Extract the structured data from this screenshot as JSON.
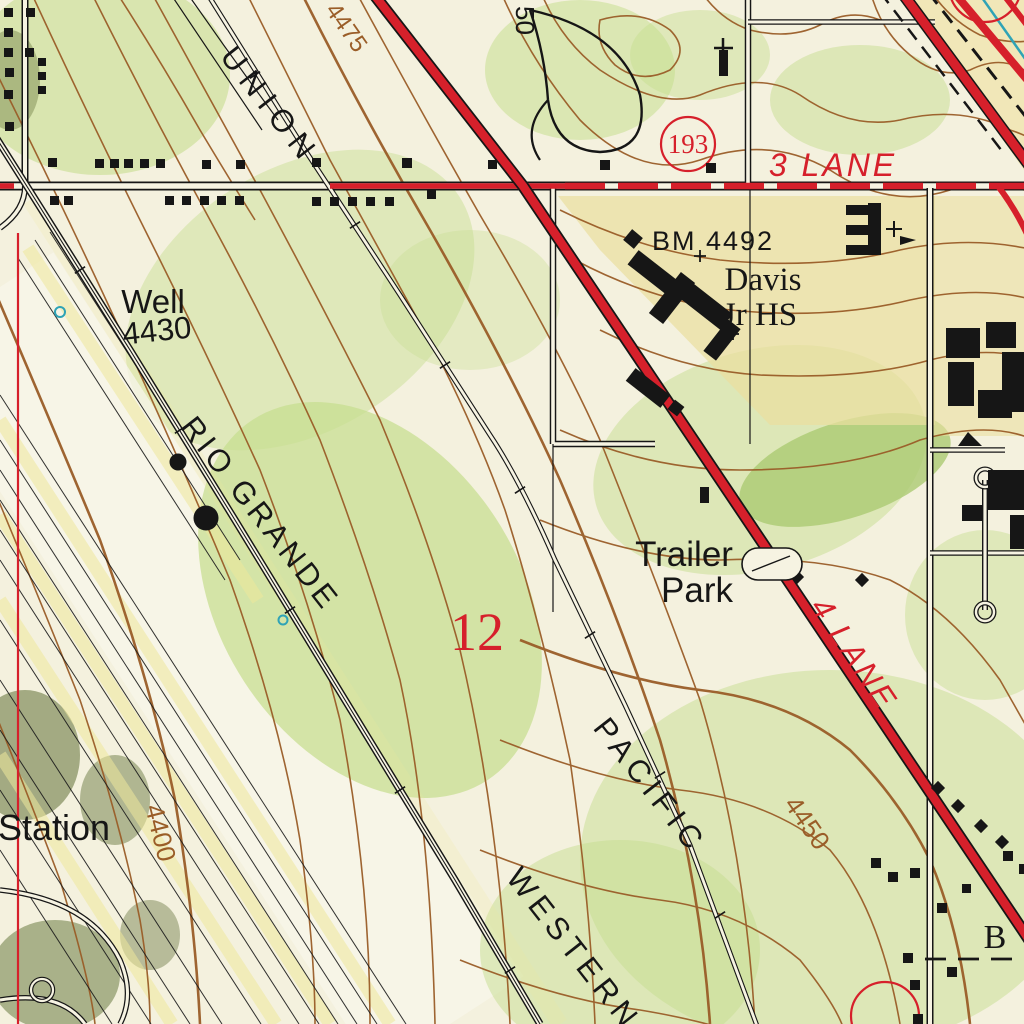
{
  "map": {
    "kind": "usgs-topographic-map-detail",
    "colors": {
      "paper": "#f4f1de",
      "highway_red": "#d6202b",
      "contour_brown": "#9a5d28",
      "vegetation_green": "#c6de8f",
      "urban_tan": "#eadfa0",
      "water_cyan": "#2fa3b6",
      "ink_black": "#161616"
    },
    "labels": {
      "railroad_union": "UNION",
      "railroad_pacific": "PACIFIC",
      "railroad_rio_grande": "RIO GRANDE",
      "railroad_western": "WESTERN",
      "well": "Well",
      "well_elevation": "4430",
      "station": "Station",
      "benchmark": "BM 4492",
      "school_line1": "Davis",
      "school_line2": "Jr HS",
      "trailer_line1": "Trailer",
      "trailer_line2": "Park",
      "route_shield": "193",
      "road_three_lane": "3 LANE",
      "road_four_lane": "4 LANE",
      "section_number": "12",
      "contour_4475": "4475",
      "contour_4450": "4450",
      "contour_4400": "4400",
      "edge_letter_b": "B",
      "edge_street_50": "50"
    },
    "symbols": [
      {
        "name": "route-shield-circle-icon",
        "meaning": "state route 193 shield"
      },
      {
        "name": "benchmark-diamond-icon",
        "meaning": "benchmark at BM 4492"
      },
      {
        "name": "water-tank-dot-icon",
        "meaning": "storage tanks along Rio Grande tracks"
      },
      {
        "name": "well-circle-icon",
        "meaning": "small water well circles (cyan)"
      },
      {
        "name": "railroad-tick-icon",
        "meaning": "railroad cross ties"
      },
      {
        "name": "building-square-icon",
        "meaning": "small black building footprints"
      }
    ]
  }
}
